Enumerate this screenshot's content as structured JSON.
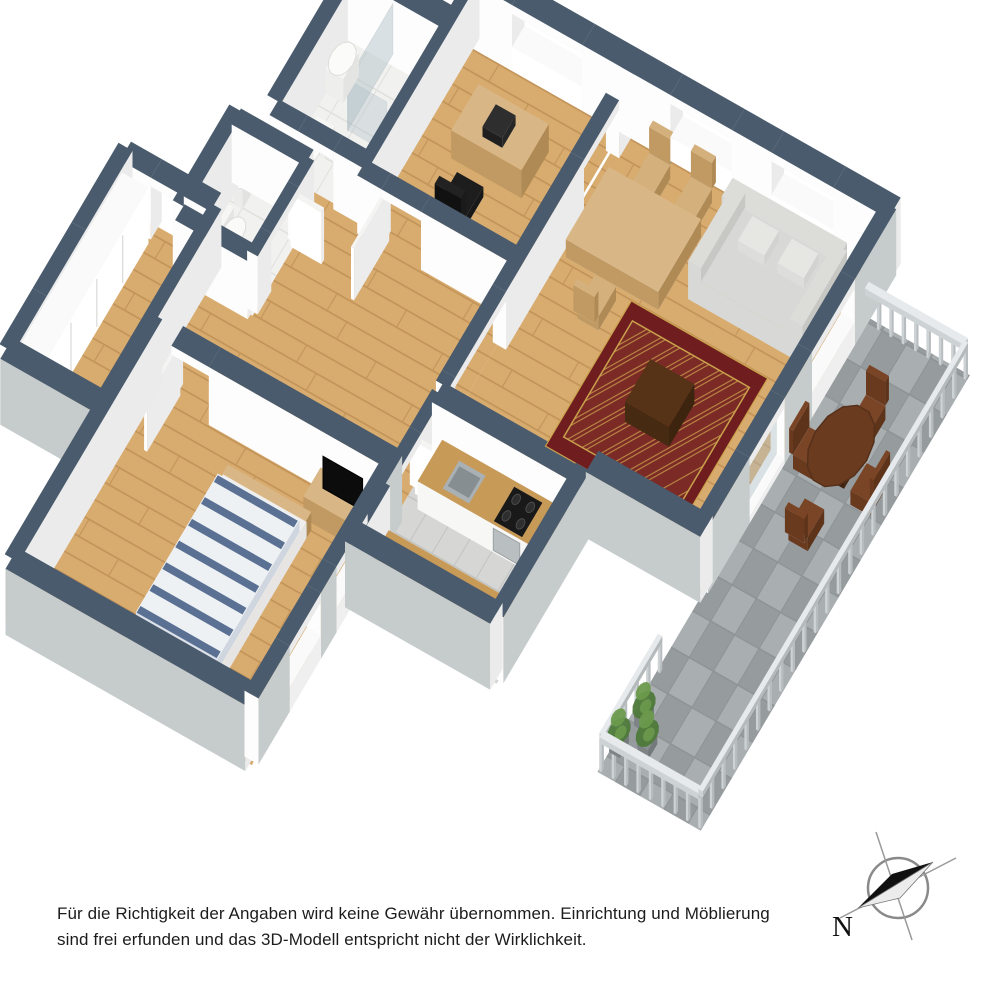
{
  "page": {
    "background": "#ffffff",
    "kind": "3d-floor-plan-rendering"
  },
  "disclaimer": {
    "line1": "Für die Richtigkeit der Angaben wird keine Gewähr übernommen. Einrichtung und Möblierung",
    "line2": "sind frei erfunden und das 3D-Modell entspricht nicht der Wirklichkeit."
  },
  "compass": {
    "label": "N"
  },
  "colors": {
    "background": "#ffffff",
    "wall_top": "#4a5b6d",
    "wall_face": "#fdfdfd",
    "wall_face_shaded": "#ebebeb",
    "wall_exterior": "#c6cbcb",
    "floor_wood": "#d8ab6e",
    "floor_wood_line": "#c3945a",
    "floor_tile_gray": "#d6d7d5",
    "floor_tile_gray_line": "#c2c4c2",
    "floor_tile_white": "#f1f1ef",
    "floor_tile_white_line": "#e0e0dd",
    "paver_light": "#a9aeb1",
    "paver_dark": "#969b9e",
    "paver_line": "#8e9396",
    "rug_field": "#7c2a26",
    "rug_border": "#6f1d1e",
    "rug_accent": "#c9a24c",
    "sofa": "#d8d9d6",
    "sofa_shade": "#c7c8c4",
    "wood_furniture": "#d9b685",
    "wood_furniture_shade": "#c09a62",
    "counter_wood": "#c89a58",
    "wood_dark": "#5b3a22",
    "outdoor_wood": "#6e4124",
    "bed_stripe": "#5a7193",
    "bed_white": "#eef1f4",
    "plant_green": "#4e7a3a",
    "plant_green_light": "#6a9a4c",
    "glass": "#aebfc6",
    "steel": "#b9bec1",
    "black": "#161616",
    "railing": "#cdd2d4",
    "compass_line": "#8a8a8a",
    "text": "#1c1c1c"
  },
  "floorplan": {
    "view": "3d-isometric",
    "rooms": [
      {
        "id": "office",
        "floor": "wood",
        "furniture": [
          "desk",
          "laptop",
          "office-chair"
        ]
      },
      {
        "id": "living-dining",
        "floor": "wood",
        "furniture": [
          "dining-table",
          "dining-chairs",
          "sofa",
          "cushions",
          "coffee-table",
          "oriental-rug"
        ]
      },
      {
        "id": "kitchen",
        "floor": "tile-gray",
        "furniture": [
          "counter-with-sink",
          "cooktop",
          "oven",
          "second-counter"
        ]
      },
      {
        "id": "hallway",
        "floor": "wood",
        "furniture": [
          "open-doors"
        ]
      },
      {
        "id": "bathroom",
        "floor": "tile-white",
        "furniture": [
          "shower-glass",
          "washbasin",
          "toilet"
        ]
      },
      {
        "id": "wc",
        "floor": "tile-white",
        "furniture": [
          "toilet",
          "washbasin"
        ]
      },
      {
        "id": "dressing-room",
        "floor": "wood",
        "furniture": [
          "wardrobe-row"
        ]
      },
      {
        "id": "bedroom",
        "floor": "wood",
        "furniture": [
          "double-bed-striped",
          "pillows",
          "tv-sideboard",
          "tv"
        ]
      },
      {
        "id": "balcony",
        "floor": "pavers",
        "furniture": [
          "railing",
          "round-table",
          "four-chairs",
          "plants"
        ]
      }
    ]
  }
}
